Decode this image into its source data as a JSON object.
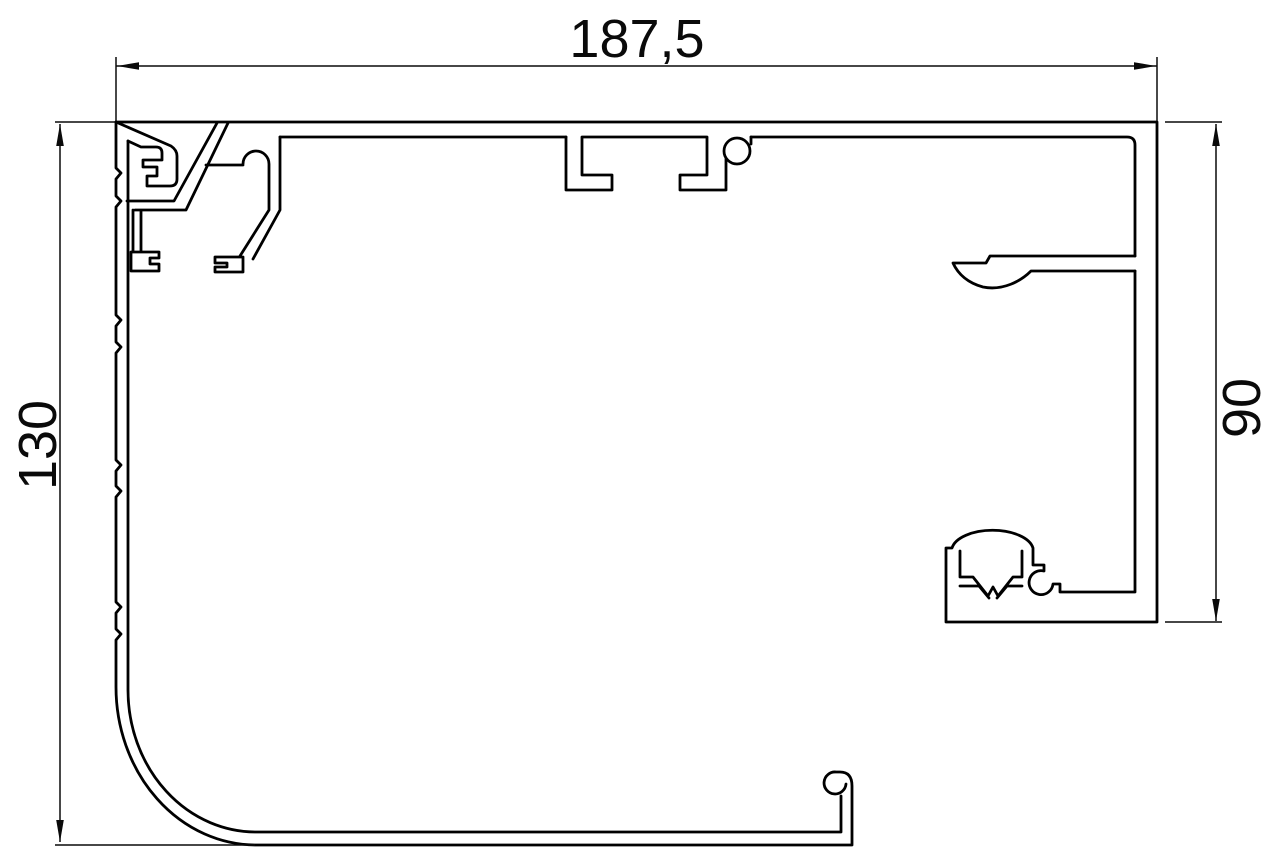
{
  "page": {
    "background": "#ffffff"
  },
  "drawing": {
    "title": "Aluminium profile cross-section technical drawing",
    "canvas": {
      "width": 1280,
      "height": 866
    },
    "stroke_color": "#000000",
    "dim_color": "#0a0a0a",
    "dimensions": {
      "width": {
        "label": "187,5"
      },
      "height": {
        "label": "130"
      },
      "right_height": {
        "label": "90"
      }
    },
    "profile_paths": [
      "M116,122 V168 l5,5 -5,6 V196 l5,5 -5,6 V315 l5,5 -5,6 V342 l5,5 -5,6 V460 l5,5 -5,6 V486 l5,5 -5,6 V602 l5,5 -5,6 V629 l5,5 -5,6 V687 A140,158 0 0 0 256,845 H852 V786 Q852,772 840,772 H836 A11,11 0 1 0 846,784",
      "M841,796 V832 H258 A128,142 0 0 1 128,690 V141",
      "M116,122 H1157 V622 H946 V548 H952 A41,21 0 0 1 1033,548 V565 H1044 V571 A12,12 0 1 0 1053,584 H1060 V592 H1135 V271",
      "M1135,256 H990 L986,263 H953 C958,274 968,283 983,287 C1003,291 1021,281 1031,271 H1135",
      "M1135,256 V145 Q1135,137 1127,137 H751",
      "M751,137 V144 M724,151 a13,13 0 1 0 26,0 a13,13 0 1 0 -26,0 M680,175 V190 H726 V158 M680,175 H707 V138",
      "M566,137 V190 H612 V175 H582 V138",
      "M280,137 H566 M582,137 H707",
      "M116,122 L171,146 Q177,150 177,156 V179 Q177,186 170,186 H147 V176 H157 V167 H143 V160 H162 V153 Q162,147 156,147 H141 L128,141",
      "M127,201 H174 L217,123 M135,210 H186 L228,123 M133,210 V252 M141,210 V252 M131,252 H159 V258 H150 V264 H159 V271 H131 Z",
      "M206,165 H243 M243,164 A13,13 0 1 1 269,164 M269,164 V210 L240,256 M280,137 V210 L253,259 M243,257 H215 V263 H227 V267 H215 V272 H243 Z",
      "M960,551 V577 M1022,551 V577 M960,577 H973 L988,596 L993,587 L998,596 L1013,577 H1022 M960,586 H979 L989,598 M997,598 L1007,586 H1022"
    ],
    "dim_paths": [
      "M116,57 V121",
      "M1157,57 V121",
      "M55,122 H115",
      "M1165,122 H1222",
      "M1165,622 H1222",
      "M55,845 H255",
      "M116,66 H1157",
      "M60,124 V842",
      "M1216,124 V621"
    ],
    "arrow_polygons": [
      "117,66 139,62.2 139,69.8",
      "1156,66 1134,62.2 1134,69.8",
      "60,124 56.2,146 63.8,146",
      "60,842 56.2,820 63.8,820",
      "1216,124 1212.2,146 1219.8,146",
      "1216,621 1212.2,599 1219.8,599"
    ]
  }
}
